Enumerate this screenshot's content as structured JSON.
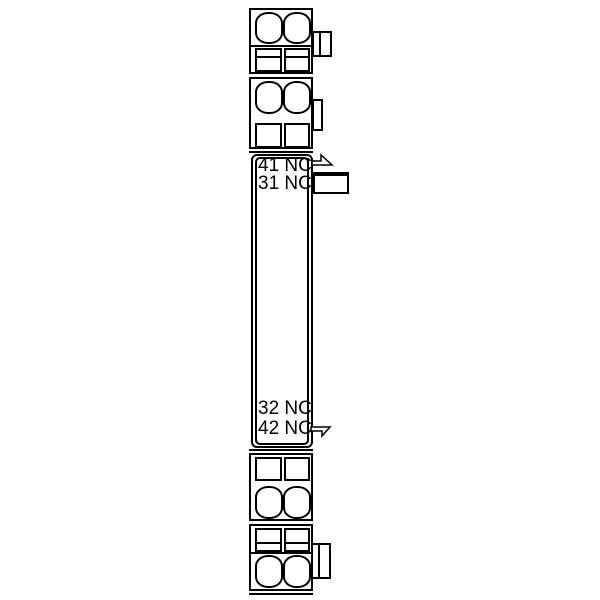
{
  "diagram": {
    "background_color": "#ffffff",
    "line_color": "#000000",
    "labels": {
      "top_terminal_1": "41 NC",
      "top_terminal_2": "31 NC",
      "bottom_terminal_1": "32 NC",
      "bottom_terminal_2": "42 NC"
    }
  }
}
